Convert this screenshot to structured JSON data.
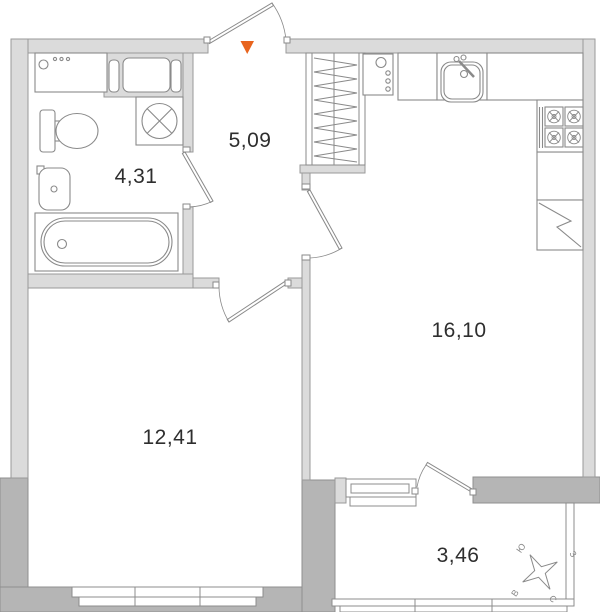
{
  "floor_plan": {
    "rooms": [
      {
        "id": "bathroom",
        "area": "4,31"
      },
      {
        "id": "hallway",
        "area": "5,09"
      },
      {
        "id": "kitchen_living",
        "area": "16,10"
      },
      {
        "id": "living_room",
        "area": "12,41"
      },
      {
        "id": "balcony",
        "area": "3,46"
      }
    ],
    "compass": {
      "north": "С",
      "south": "Ю",
      "east": "В",
      "west": "З"
    },
    "entrance_marker_color": "#E8641E",
    "colors": {
      "wall_light": "#DBDBDB",
      "wall_dark": "#B5B5B5",
      "outline": "#8F8F8F",
      "text": "#2E2E2E"
    },
    "fixtures": [
      "bathtub",
      "toilet",
      "wash-basin",
      "washing-machine",
      "ventilation-fan",
      "counter",
      "wardrobe",
      "kitchen-sink",
      "gas-stove",
      "refrigerator",
      "boiler",
      "windows",
      "balcony-glazing",
      "compass-rose",
      "entrance-door"
    ]
  }
}
